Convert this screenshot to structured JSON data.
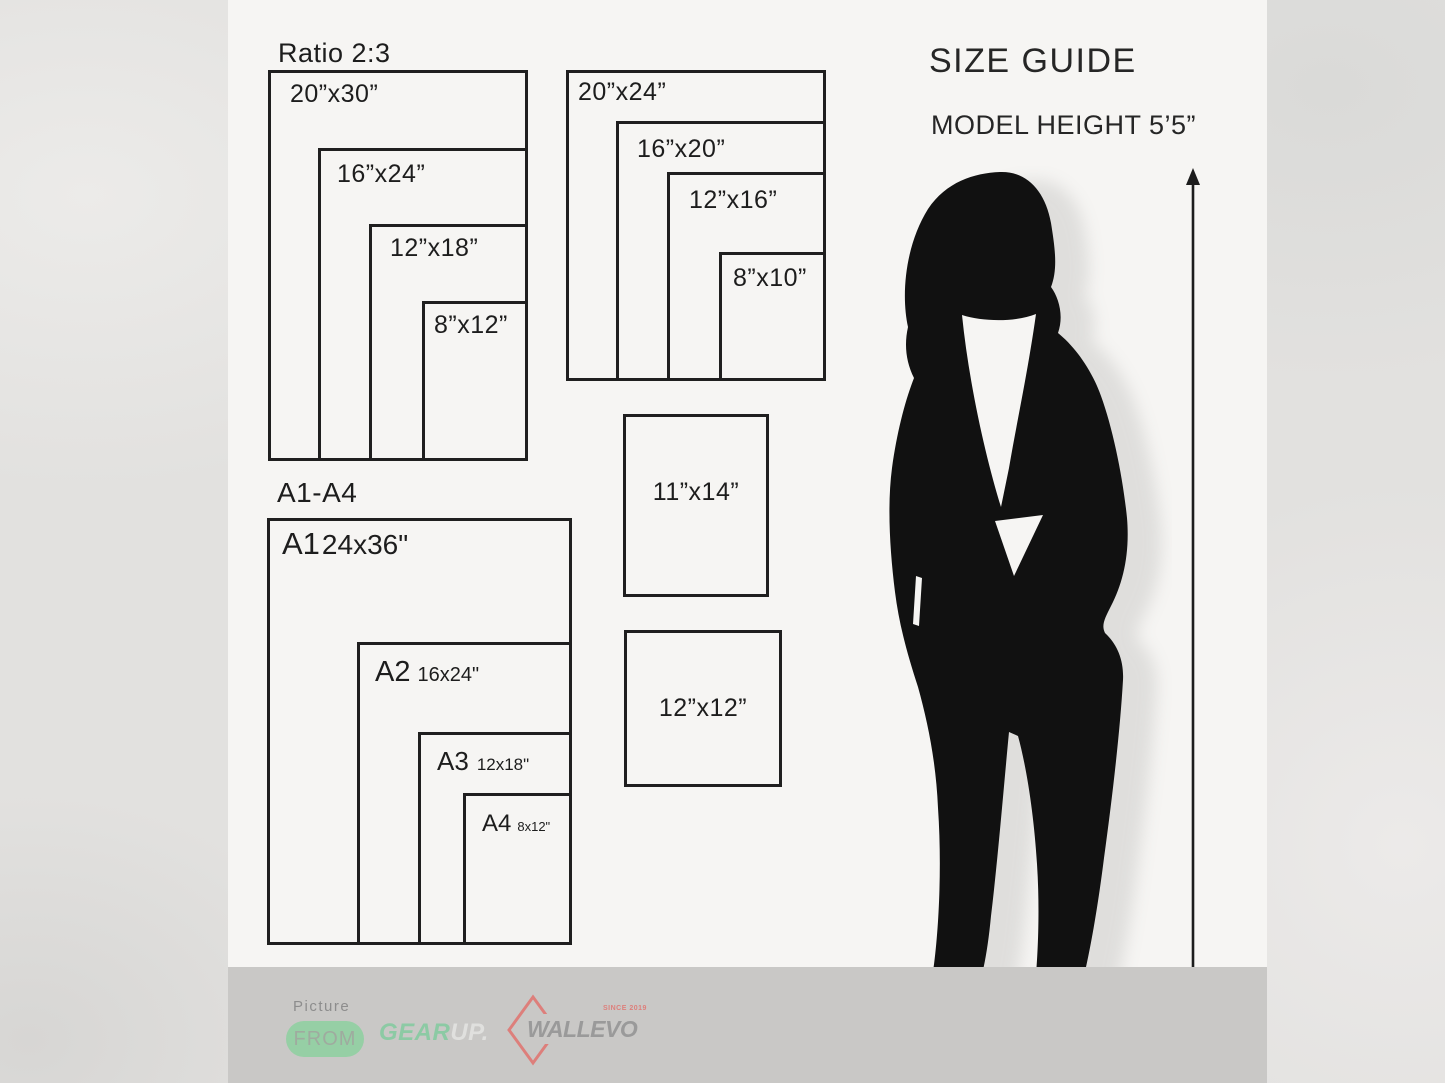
{
  "header": {
    "title": "SIZE GUIDE",
    "model_height": "MODEL HEIGHT 5’5”"
  },
  "ratio_2_3": {
    "heading": "Ratio 2:3",
    "sizes": [
      "20”x30”",
      "16”x24”",
      "12”x18”",
      "8”x12”"
    ]
  },
  "ratio_4_5": {
    "sizes": [
      "20”x24”",
      "16”x20”",
      "12”x16”",
      "8”x10”"
    ]
  },
  "singles": {
    "s11x14": "11”x14”",
    "s12x12": "12”x12”"
  },
  "a_series": {
    "heading": "A1-A4",
    "items": [
      {
        "label": "A1",
        "dim": "24x36\""
      },
      {
        "label": "A2",
        "dim": "16x24\""
      },
      {
        "label": "A3",
        "dim": "12x18\""
      },
      {
        "label": "A4",
        "dim": "8x12\""
      }
    ]
  },
  "footer": {
    "picture": "Picture",
    "from": "FROM",
    "gear": "GEAR",
    "up": "UP.",
    "brand": "WALLEVO",
    "since": "SINCE 2019"
  },
  "colors": {
    "line": "#1f1f1f",
    "silhouette_black": "#111111",
    "canvas_white": "#f6f5f3",
    "footer_gray": "#c9c8c6",
    "accent_green": "#96cfa5",
    "accent_teal": "#8ccaa4",
    "accent_salmon": "#dd7f7b"
  }
}
